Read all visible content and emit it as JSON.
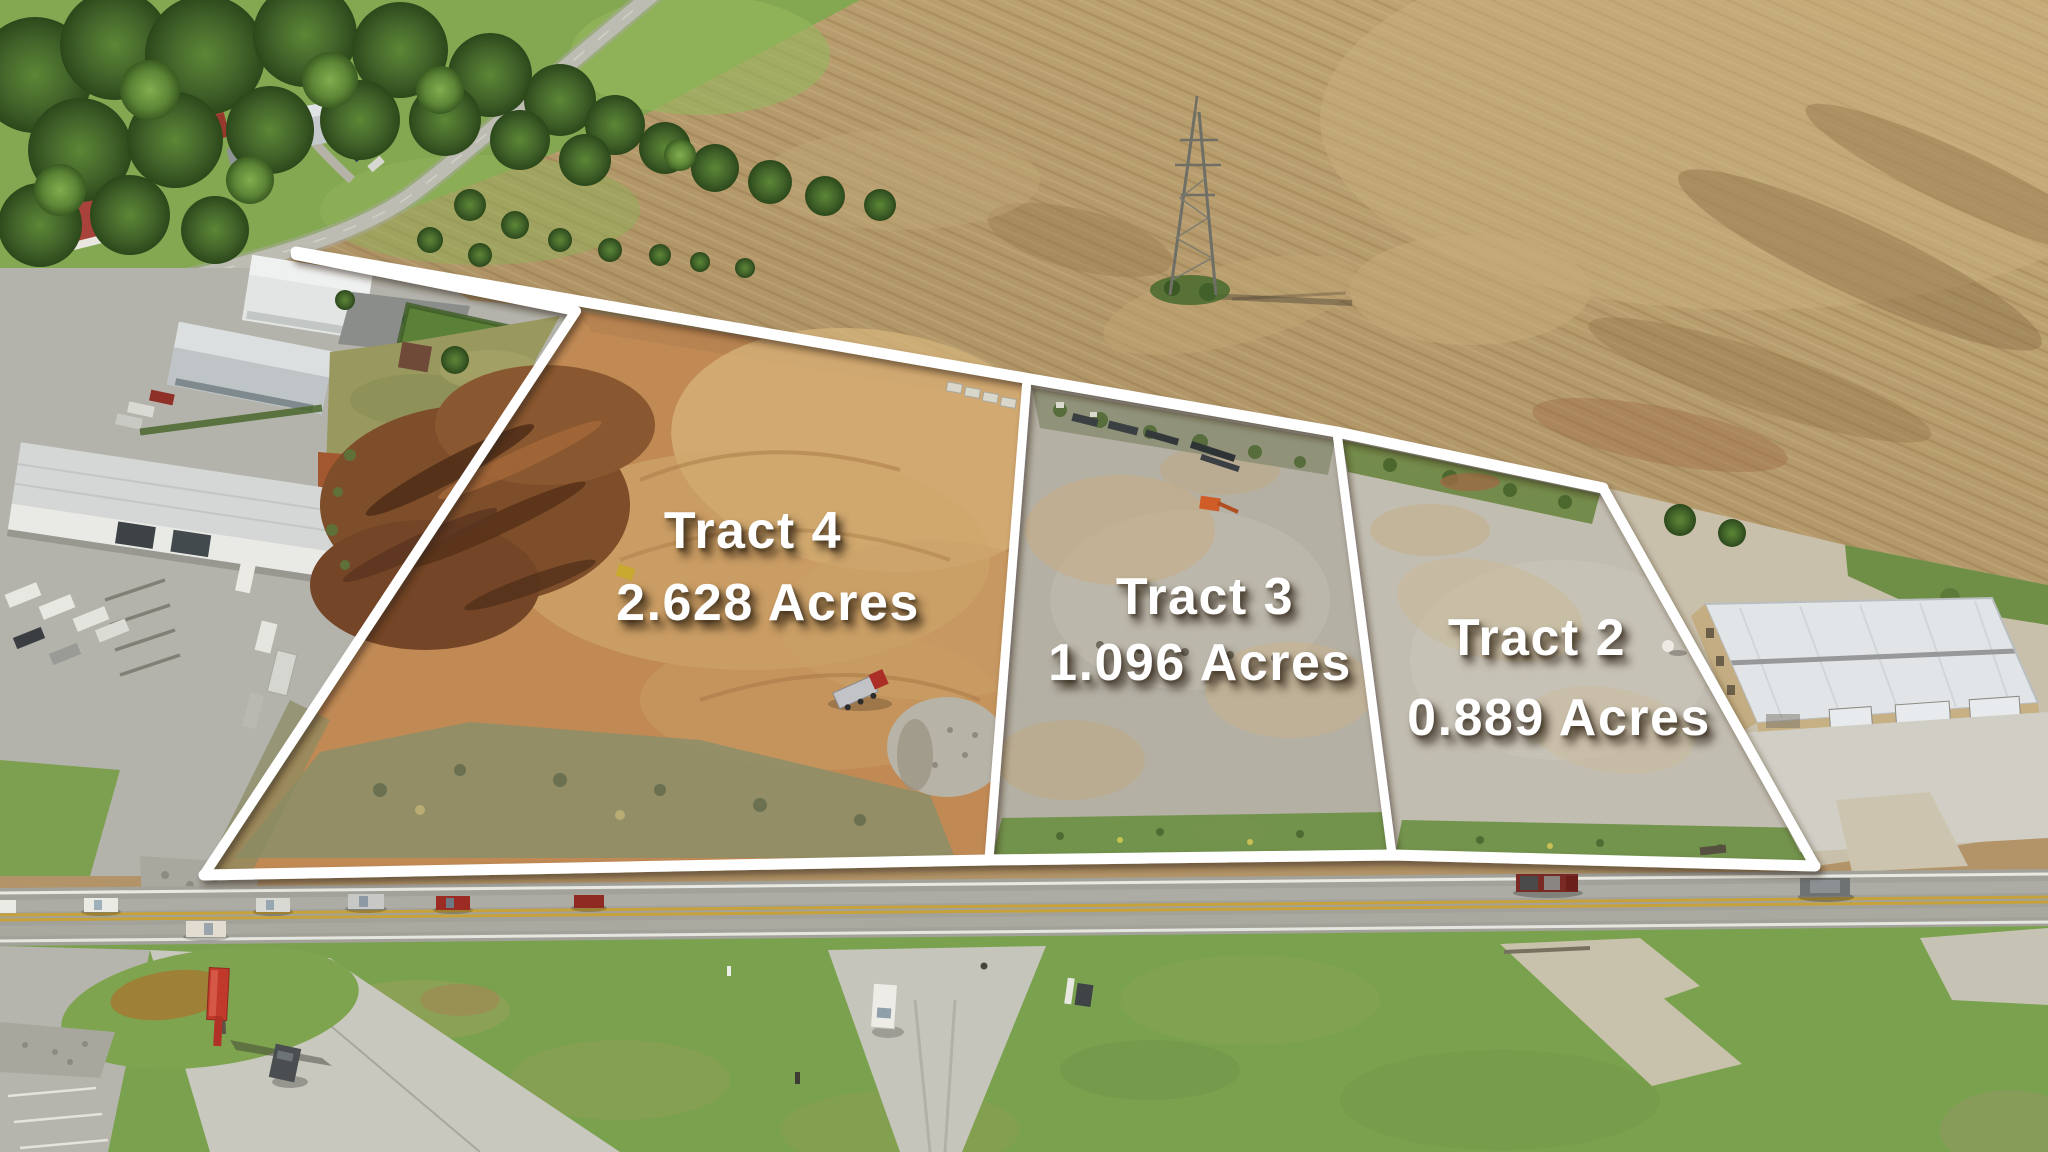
{
  "scene_title": "Aerial tract map photo",
  "tracts": [
    {
      "id": "tract-4",
      "label": "Tract 4",
      "acreage": "2.628 Acres"
    },
    {
      "id": "tract-3",
      "label": "Tract 3",
      "acreage": "1.096 Acres"
    },
    {
      "id": "tract-2",
      "label": "Tract 2",
      "acreage": "0.889 Acres"
    }
  ],
  "colors": {
    "boundary_line": "#ffffff",
    "label_text": "#ffffff",
    "plowed_field": "#b29468",
    "tract4_dirt": "#c18a55",
    "tract3_gravel": "#b4b0a4",
    "tract2_gravel": "#c2bdb1",
    "grass": "#7aa14e",
    "road_asphalt": "#a2a29a",
    "road_yellow_line": "#c7a23b"
  }
}
